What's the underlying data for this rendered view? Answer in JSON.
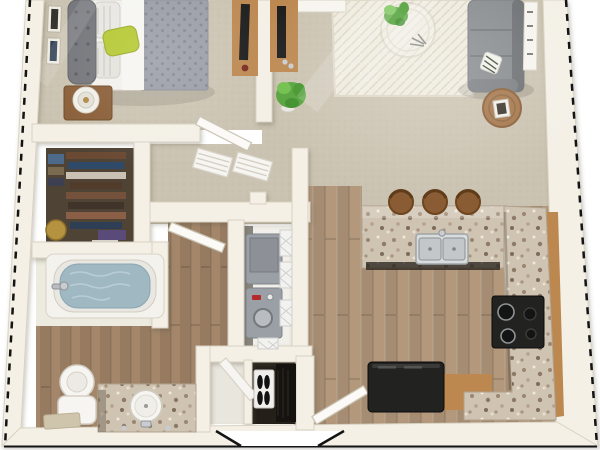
{
  "meta": {
    "description": "3D top-down floor plan rendering of a one-bedroom apartment with bedroom, walk-in closet, bathroom, laundry closet, entry, kitchen and living room",
    "render_type": "floor-plan-render"
  },
  "colors": {
    "floor_outside": "#ffffff",
    "wall": "#f4f0e6",
    "wall_shadow": "#d9d2c2",
    "carpet": "#cbc3b1",
    "wood_kitchen": "#b3987c",
    "wood_bath": "#a4876a",
    "granite": "#cfc3b2",
    "cabinet": "#bc8850",
    "cabinet_dark": "#96ordv6b3b",
    "sofa": "#868a8d",
    "sofa_dark": "#6c6f72",
    "bed_duvet": "#9a9da6",
    "headboard": "#73757a",
    "accent_pillow": "#b5c832",
    "plant": "#55a33c",
    "rug": "#efebdf",
    "appliance_black": "#222221",
    "washer": "#9aa0a6",
    "water": "#9fb8c2",
    "closet_dark": "#4f4336",
    "white_fixture": "#f6f5f1",
    "nightstand": "#8a5f38",
    "outline_dash": "#141414"
  },
  "objects": [
    "bed",
    "headboard",
    "green-accent-pillow",
    "nightstand",
    "table-lamp",
    "wall-frames",
    "tv-console-bedroom",
    "tv-console-living",
    "potted-plant",
    "area-rug",
    "coffee-table",
    "sectional-sofa",
    "throw-pillow",
    "side-table",
    "wall-console",
    "walk-in-closet-clothes",
    "bathtub",
    "toilet",
    "vanity-sink",
    "bath-mat",
    "washer",
    "dryer",
    "wire-shelves",
    "shoe-closet",
    "ironing-board",
    "front-door",
    "bedroom-door",
    "bathroom-door",
    "breakfast-bar",
    "bar-stools",
    "double-sink",
    "range-stove",
    "refrigerator",
    "kitchen-cabinets"
  ]
}
